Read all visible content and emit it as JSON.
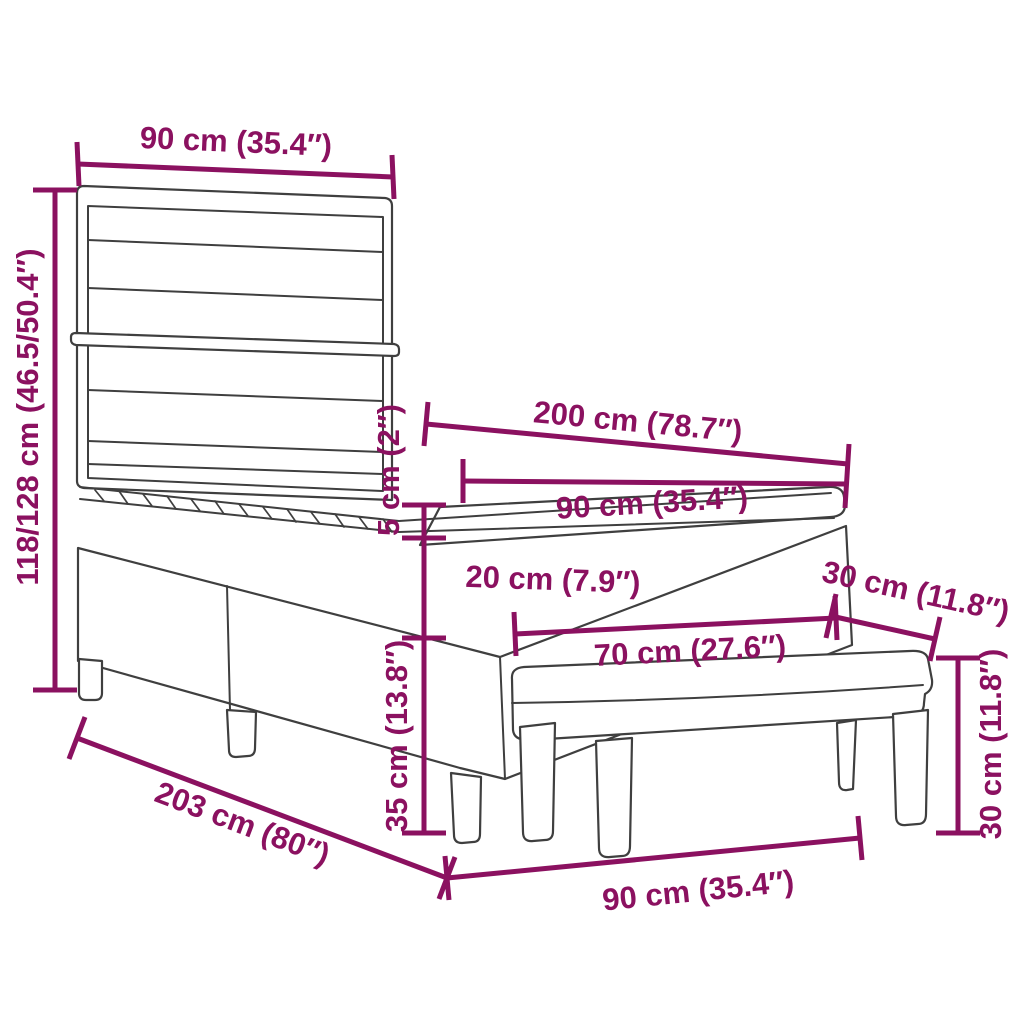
{
  "colors": {
    "dimension_accent": "#8B1160",
    "furniture_outline": "#3F3F3F",
    "background": "#FFFFFF"
  },
  "dimensions": {
    "headboard_width": "90 cm (35.4″)",
    "headboard_height": "118/128 cm (46.5/50.4″)",
    "mattress_length": "200 cm (78.7″)",
    "mattress_width": "90 cm (35.4″)",
    "topper_thickness": "5 cm (2″)",
    "mattress_thickness": "20 cm (7.9″)",
    "frame_height": "35 cm (13.8″)",
    "bench_length": "70 cm (27.6″)",
    "bench_depth": "30 cm (11.8″)",
    "bench_height": "30 cm (11.8″)",
    "bed_total_length": "203 cm (80″)",
    "bed_width": "90 cm (35.4″)"
  }
}
